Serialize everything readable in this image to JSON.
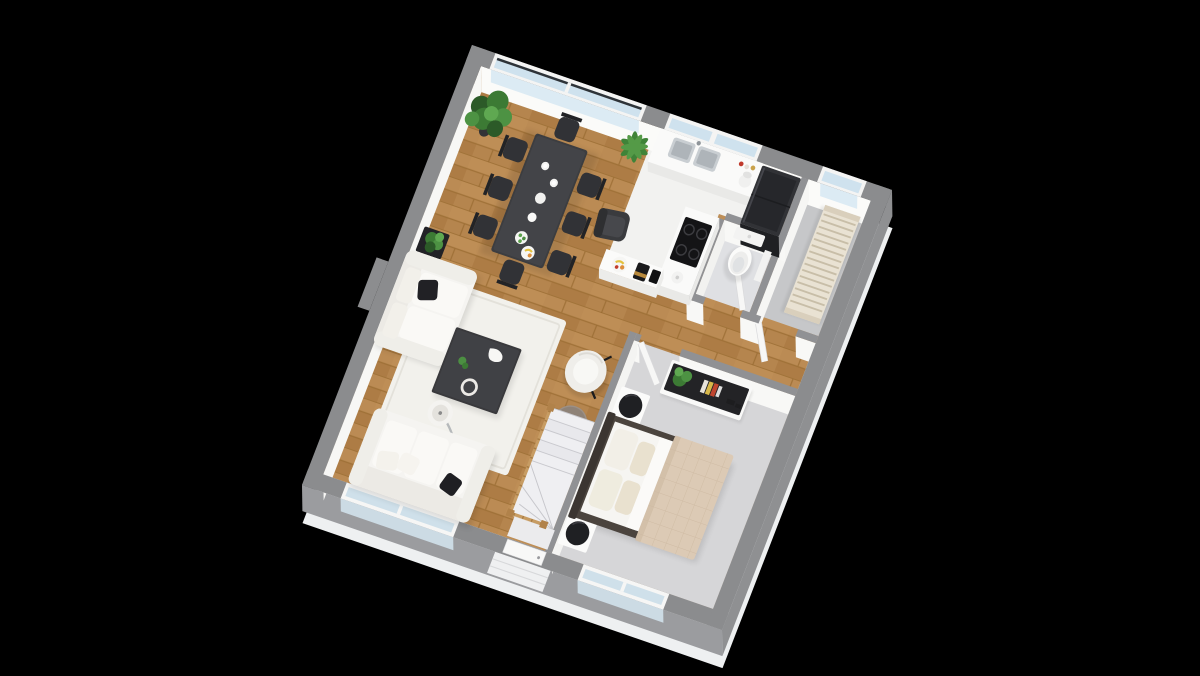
{
  "scene": {
    "type": "3d-floor-plan-render",
    "view": "rotated axonometric top-down",
    "background": "#000000"
  },
  "palette": {
    "wall_top": "#8b8c8e",
    "wall_face_interior": "#fbfbf9",
    "wall_face_exterior": "#9a9b9e",
    "floor_slab": "#eef0f1",
    "wood_floor": "#b5854e",
    "kitchen_floor": "#f2f2f0",
    "bathroom_floor": "#dfe0e3",
    "utility_floor": "#c6c7c9",
    "bedroom_carpet": "#d6d6d8",
    "glass": "#cfe2ee",
    "furniture_dark": "#39393c",
    "upholstery_white": "#f5f4f1",
    "quilt_beige": "#dccab5",
    "plant_green": "#3c7a34",
    "banister_wood": "#c79c63"
  },
  "rooms": [
    {
      "id": "living-dining",
      "floor": "oak wood planks",
      "items": [
        "dining table",
        "8 dark dining chairs",
        "table dishes and fruit bowls",
        "two-seat sofa with black pillow",
        "three-seat sofa with pillows",
        "white area rug",
        "dark square coffee table",
        "arc floor lamp",
        "white barrel armchair",
        "round side table",
        "dark lounge chair",
        "large potted plant",
        "palm plant",
        "small plant on black planter",
        "winder staircase with wooden banister"
      ]
    },
    {
      "id": "kitchen",
      "floor": "white tile",
      "items": [
        "counter with double stainless sink",
        "stand mixer",
        "spice jars",
        "tall black refrigerator",
        "counter with 4-burner cooktop",
        "kettle",
        "peninsula counter",
        "fruit plate",
        "coffee maker",
        "black canister"
      ]
    },
    {
      "id": "bathroom",
      "floor": "light gray tile",
      "items": [
        "toilet",
        "wall cabinet",
        "open door"
      ]
    },
    {
      "id": "utility-room",
      "floor": "gray screed",
      "items": [
        "slatted radiator",
        "open door"
      ]
    },
    {
      "id": "hallway",
      "floor": "oak wood planks",
      "items": []
    },
    {
      "id": "bedroom",
      "floor": "gray carpet",
      "items": [
        "double bed with beige quilt and pillows",
        "2 white nightstands with round black lamps",
        "sideboard with black top, plant and books",
        "open door"
      ]
    }
  ],
  "openings": {
    "glass_sliding_doors": "top-left of north wall, 2 panes",
    "kitchen_windows": 2,
    "utility_window": 1,
    "living_room_windows": "2 panes on south wall behind sofa",
    "bedroom_window": "south wall, 2 panes",
    "front_door": "south wall at bottom of staircase with exterior porch"
  }
}
